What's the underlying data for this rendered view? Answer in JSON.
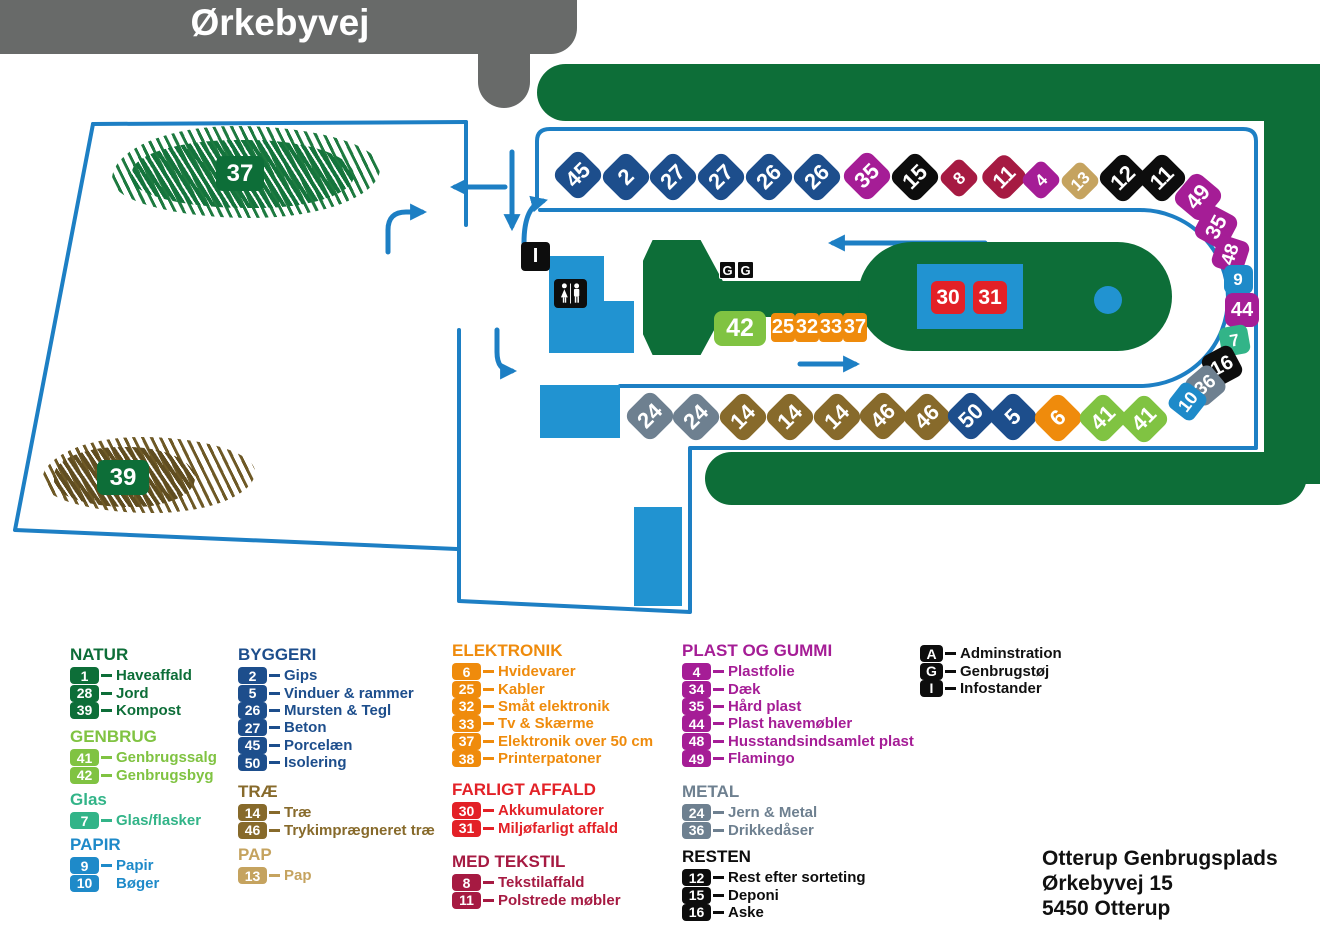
{
  "banner": {
    "road_name": "Ørkebyvej"
  },
  "address": {
    "line1": "Otterup Genbrugsplads",
    "line2": "Ørkebyvej 15",
    "line3": "5450 Otterup"
  },
  "colors": {
    "map_green": "#0d6e38",
    "light_green": "#80c342",
    "teal": "#32b488",
    "blue": "#1e8ac9",
    "dark_blue": "#1d4e8c",
    "brown": "#876a2b",
    "tan": "#c5a35f",
    "orange": "#ef8b0c",
    "red": "#e32127",
    "crimson": "#a61a42",
    "magenta": "#a51d96",
    "metal_gray": "#6e8090",
    "black": "#0d0d0d",
    "road_line_blue": "#1d7fc4",
    "building_blue": "#2193d1",
    "banner_gray": "#686a69"
  },
  "map": {
    "area_labels": [
      {
        "num": "37",
        "desc": "kompost-areal"
      },
      {
        "num": "39",
        "desc": "jord-areal"
      }
    ],
    "island": {
      "hazard_badges": [
        "30",
        "31"
      ],
      "genbrug_badges": [
        "G",
        "G"
      ],
      "info_badge": "I",
      "ramp_badge": "42",
      "electronics_badges": [
        "25",
        "32",
        "33",
        "37"
      ]
    },
    "markers": [
      {
        "num": "45",
        "color": "dark_blue",
        "x": 578,
        "y": 175,
        "s": 38,
        "rot": -45
      },
      {
        "num": "2",
        "color": "dark_blue",
        "x": 626,
        "y": 177,
        "s": 38,
        "rot": -45
      },
      {
        "num": "27",
        "color": "dark_blue",
        "x": 673,
        "y": 177,
        "s": 38,
        "rot": -45
      },
      {
        "num": "27",
        "color": "dark_blue",
        "x": 721,
        "y": 177,
        "s": 38,
        "rot": -45
      },
      {
        "num": "26",
        "color": "dark_blue",
        "x": 769,
        "y": 177,
        "s": 38,
        "rot": -45
      },
      {
        "num": "26",
        "color": "dark_blue",
        "x": 817,
        "y": 177,
        "s": 38,
        "rot": -45
      },
      {
        "num": "35",
        "color": "magenta",
        "x": 867,
        "y": 176,
        "s": 38,
        "rot": -45
      },
      {
        "num": "15",
        "color": "black",
        "x": 915,
        "y": 177,
        "s": 38,
        "rot": -45
      },
      {
        "num": "8",
        "color": "crimson",
        "x": 959,
        "y": 178,
        "s": 30,
        "rot": -45
      },
      {
        "num": "11",
        "color": "crimson",
        "x": 1004,
        "y": 177,
        "s": 36,
        "rot": -45
      },
      {
        "num": "4",
        "color": "magenta",
        "x": 1041,
        "y": 180,
        "s": 30,
        "rot": -45
      },
      {
        "num": "13",
        "color": "tan",
        "x": 1080,
        "y": 181,
        "s": 30,
        "rot": -45
      },
      {
        "num": "12",
        "color": "black",
        "x": 1123,
        "y": 178,
        "s": 38,
        "rot": -45
      },
      {
        "num": "11",
        "color": "black",
        "x": 1162,
        "y": 178,
        "s": 38,
        "rot": -45
      },
      {
        "num": "49",
        "color": "magenta",
        "x": 1198,
        "y": 197,
        "s": 38,
        "rot": -50
      },
      {
        "num": "35",
        "color": "magenta",
        "x": 1216,
        "y": 227,
        "s": 36,
        "rot": -62
      },
      {
        "num": "48",
        "color": "magenta",
        "x": 1230,
        "y": 254,
        "s": 33,
        "rot": -72
      },
      {
        "num": "9",
        "color": "blue",
        "x": 1238,
        "y": 279,
        "s": 29,
        "rot": 0
      },
      {
        "num": "44",
        "color": "magenta",
        "x": 1242,
        "y": 310,
        "s": 34,
        "rot": 0
      },
      {
        "num": "7",
        "color": "teal",
        "x": 1234,
        "y": 340,
        "s": 29,
        "rot": -10
      },
      {
        "num": "16",
        "color": "black",
        "x": 1222,
        "y": 366,
        "s": 34,
        "rot": -28
      },
      {
        "num": "36",
        "color": "metal_gray",
        "x": 1205,
        "y": 385,
        "s": 33,
        "rot": -40
      },
      {
        "num": "10",
        "color": "blue",
        "x": 1187,
        "y": 401,
        "s": 31,
        "rot": -52
      },
      {
        "num": "24",
        "color": "metal_gray",
        "x": 650,
        "y": 416,
        "s": 38,
        "rot": -45
      },
      {
        "num": "24",
        "color": "metal_gray",
        "x": 696,
        "y": 417,
        "s": 38,
        "rot": -45
      },
      {
        "num": "14",
        "color": "brown",
        "x": 743,
        "y": 417,
        "s": 38,
        "rot": -45
      },
      {
        "num": "14",
        "color": "brown",
        "x": 790,
        "y": 417,
        "s": 38,
        "rot": -45
      },
      {
        "num": "14",
        "color": "brown",
        "x": 837,
        "y": 417,
        "s": 38,
        "rot": -45
      },
      {
        "num": "46",
        "color": "brown",
        "x": 883,
        "y": 416,
        "s": 38,
        "rot": -45
      },
      {
        "num": "46",
        "color": "brown",
        "x": 927,
        "y": 417,
        "s": 38,
        "rot": -45
      },
      {
        "num": "50",
        "color": "dark_blue",
        "x": 971,
        "y": 416,
        "s": 38,
        "rot": -45
      },
      {
        "num": "5",
        "color": "dark_blue",
        "x": 1013,
        "y": 417,
        "s": 38,
        "rot": -45
      },
      {
        "num": "6",
        "color": "orange",
        "x": 1058,
        "y": 418,
        "s": 38,
        "rot": -45
      },
      {
        "num": "41",
        "color": "light_green",
        "x": 1103,
        "y": 418,
        "s": 38,
        "rot": -45
      },
      {
        "num": "41",
        "color": "light_green",
        "x": 1144,
        "y": 419,
        "s": 38,
        "rot": -45
      }
    ]
  },
  "legend": {
    "columns": [
      {
        "left": 70,
        "sections": [
          {
            "title": "NATUR",
            "color": "map_green",
            "top": 645,
            "items": [
              {
                "n": "1",
                "l": "Haveaffald"
              },
              {
                "n": "28",
                "l": "Jord"
              },
              {
                "n": "39",
                "l": "Kompost"
              }
            ]
          },
          {
            "title": "GENBRUG",
            "color": "light_green",
            "top": 727,
            "items": [
              {
                "n": "41",
                "l": "Genbrugssalg"
              },
              {
                "n": "42",
                "l": "Genbrugsbyg"
              }
            ]
          },
          {
            "title": "Glas",
            "color": "teal",
            "top": 790,
            "items": [
              {
                "n": "7",
                "l": "Glas/flasker"
              }
            ]
          },
          {
            "title": "PAPIR",
            "color": "blue",
            "top": 835,
            "items": [
              {
                "n": "9",
                "l": "Papir"
              },
              {
                "n": "10",
                "l": "Bøger",
                "dash": false
              }
            ]
          }
        ]
      },
      {
        "left": 238,
        "sections": [
          {
            "title": "BYGGERI",
            "color": "dark_blue",
            "top": 645,
            "items": [
              {
                "n": "2",
                "l": "Gips"
              },
              {
                "n": "5",
                "l": "Vinduer & rammer"
              },
              {
                "n": "26",
                "l": "Mursten & Tegl"
              },
              {
                "n": "27",
                "l": "Beton"
              },
              {
                "n": "45",
                "l": "Porcelæn"
              },
              {
                "n": "50",
                "l": "Isolering"
              }
            ]
          },
          {
            "title": "TRÆ",
            "color": "brown",
            "top": 782,
            "items": [
              {
                "n": "14",
                "l": "Træ"
              },
              {
                "n": "46",
                "l": "Trykimprægneret træ"
              }
            ]
          },
          {
            "title": "PAP",
            "color": "tan",
            "top": 845,
            "items": [
              {
                "n": "13",
                "l": "Pap"
              }
            ]
          }
        ]
      },
      {
        "left": 452,
        "sections": [
          {
            "title": "ELEKTRONIK",
            "color": "orange",
            "top": 641,
            "items": [
              {
                "n": "6",
                "l": "Hvidevarer"
              },
              {
                "n": "25",
                "l": "Kabler"
              },
              {
                "n": "32",
                "l": "Småt elektronik"
              },
              {
                "n": "33",
                "l": "Tv & Skærme"
              },
              {
                "n": "37",
                "l": "Elektronik over 50 cm"
              },
              {
                "n": "38",
                "l": "Printerpatoner"
              }
            ]
          },
          {
            "title": "FARLIGT AFFALD",
            "color": "red",
            "top": 780,
            "items": [
              {
                "n": "30",
                "l": "Akkumulatorer"
              },
              {
                "n": "31",
                "l": "Miljøfarligt affald"
              }
            ]
          },
          {
            "title": "MED TEKSTIL",
            "color": "crimson",
            "top": 852,
            "items": [
              {
                "n": "8",
                "l": "Tekstilaffald"
              },
              {
                "n": "11",
                "l": "Polstrede møbler"
              }
            ]
          }
        ]
      },
      {
        "left": 682,
        "sections": [
          {
            "title": "PLAST OG GUMMI",
            "color": "magenta",
            "top": 641,
            "items": [
              {
                "n": "4",
                "l": "Plastfolie"
              },
              {
                "n": "34",
                "l": "Dæk"
              },
              {
                "n": "35",
                "l": "Hård plast"
              },
              {
                "n": "44",
                "l": "Plast havemøbler"
              },
              {
                "n": "48",
                "l": "Husstandsindsamlet plast"
              },
              {
                "n": "49",
                "l": "Flamingo"
              }
            ]
          },
          {
            "title": "METAL",
            "color": "metal_gray",
            "top": 782,
            "items": [
              {
                "n": "24",
                "l": "Jern & Metal"
              },
              {
                "n": "36",
                "l": "Drikkedåser"
              }
            ]
          },
          {
            "title": "RESTEN",
            "color": "black",
            "top": 847,
            "items": [
              {
                "n": "12",
                "l": "Rest efter sorteting"
              },
              {
                "n": "15",
                "l": "Deponi"
              },
              {
                "n": "16",
                "l": "Aske"
              }
            ]
          }
        ]
      }
    ]
  },
  "facility": {
    "left": 920,
    "top": 645,
    "items": [
      {
        "letter": "A",
        "label": "Adminstration"
      },
      {
        "letter": "G",
        "label": "Genbrugstøj"
      },
      {
        "letter": "I",
        "label": "Infostander"
      }
    ]
  }
}
